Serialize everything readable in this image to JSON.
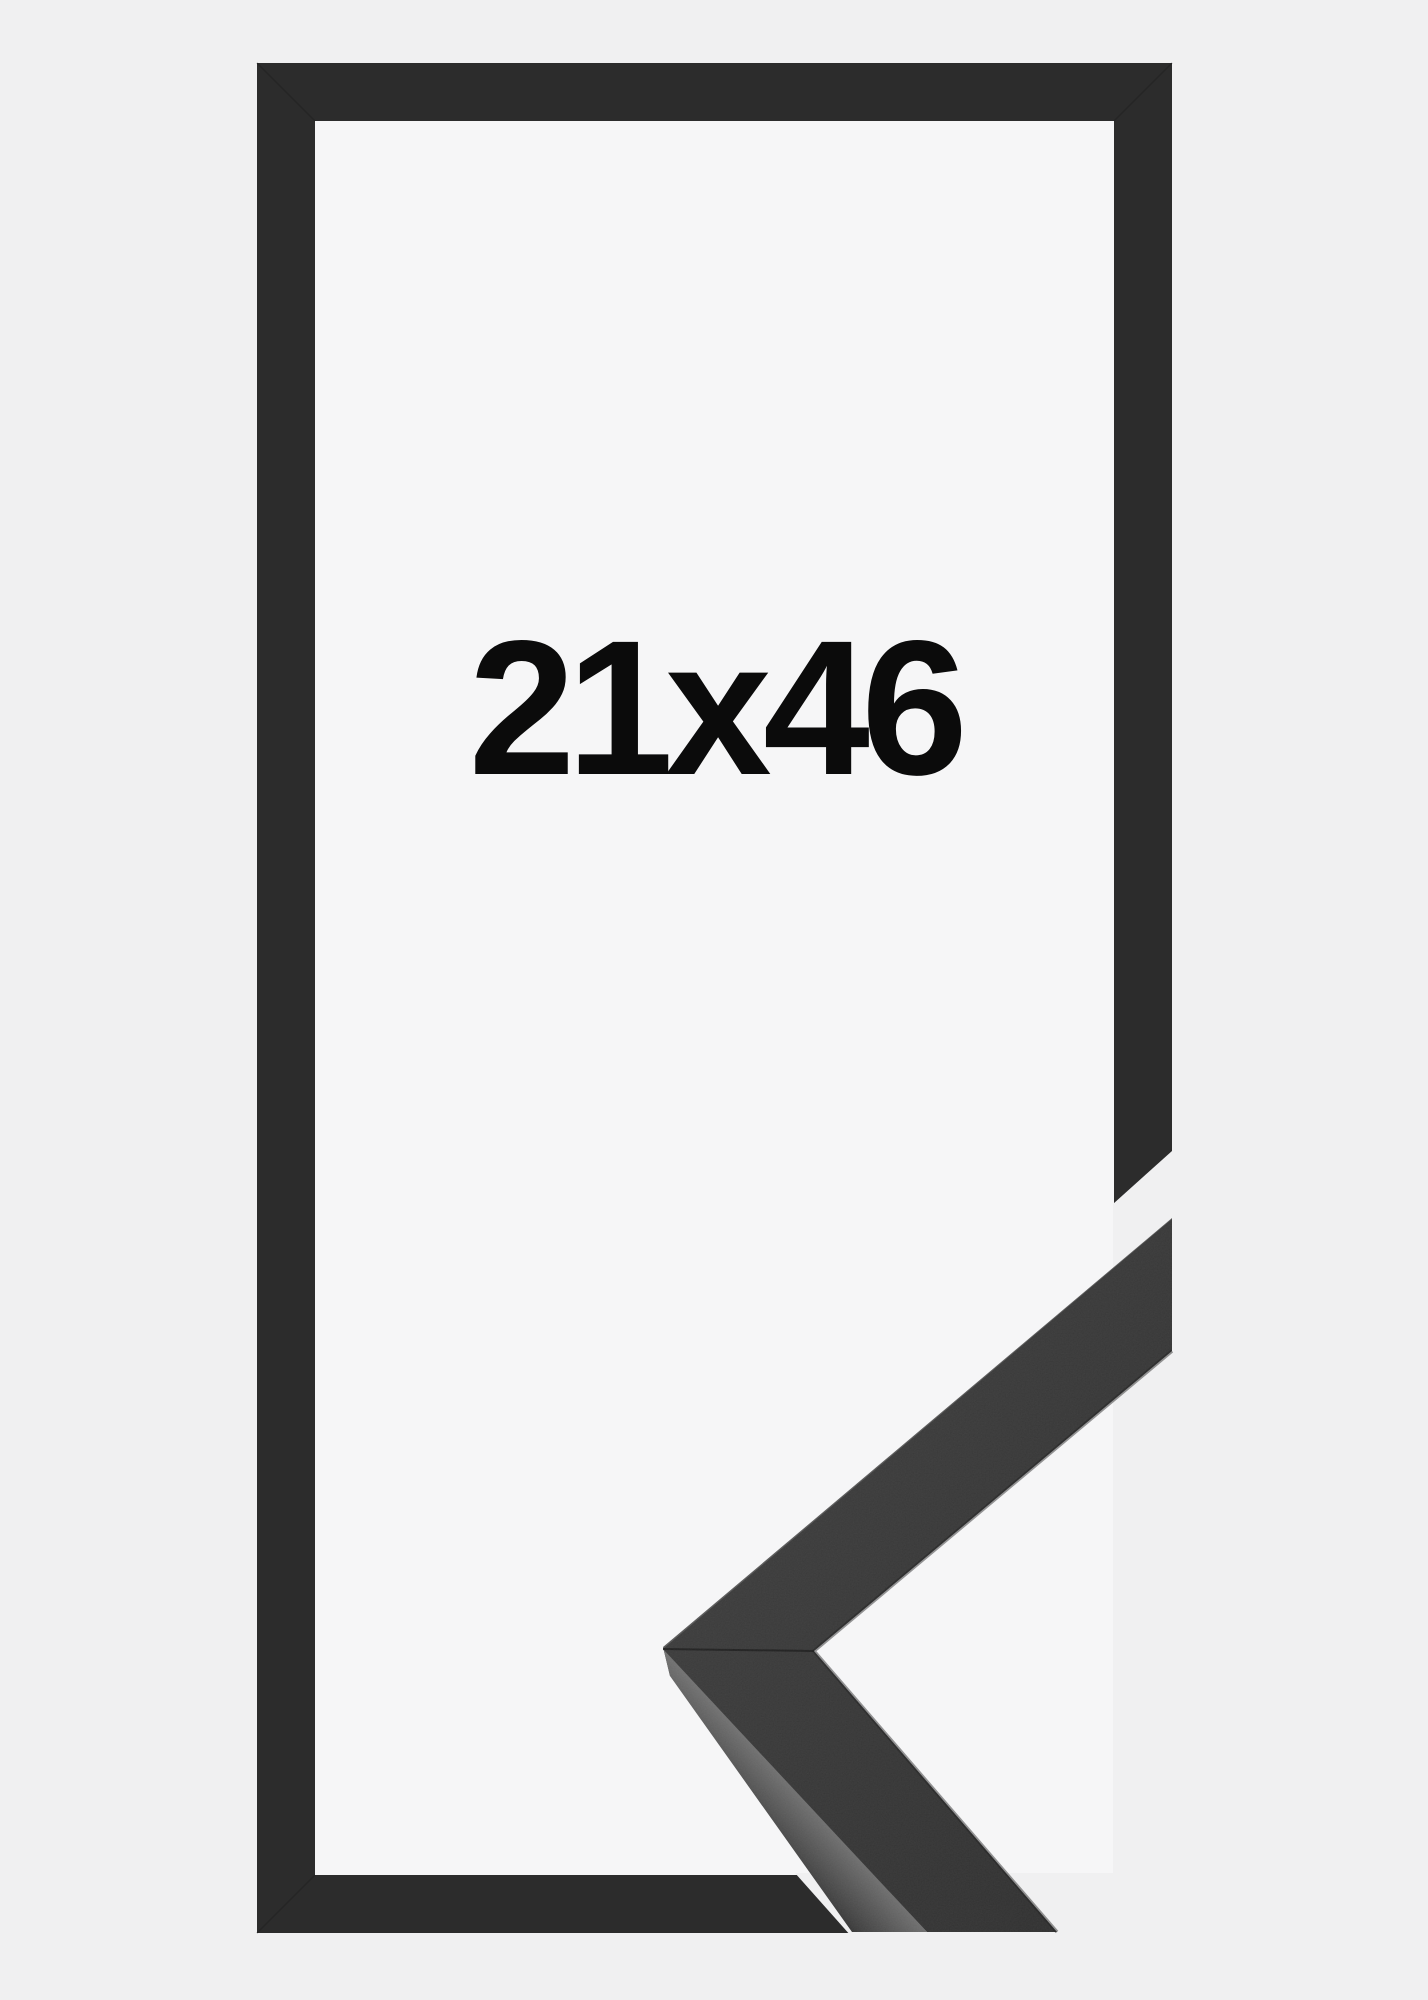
{
  "image": {
    "kind": "frame-product-photo",
    "label": {
      "text": "21x46"
    },
    "colors": {
      "background": "#f0f0f1",
      "inner_background": "#f6f6f7",
      "frame": "#2c2c2c",
      "label_text": "#0b0b0b",
      "sample_face_a": "#3a3a3a",
      "sample_face_b": "#2d2d2d",
      "sample_side_upper_a": "#585858",
      "sample_side_upper_b": "#383838",
      "sample_side_lower_a": "#6f6f6f",
      "sample_side_lower_b": "#424242",
      "seam": "#1a1a1a"
    }
  }
}
